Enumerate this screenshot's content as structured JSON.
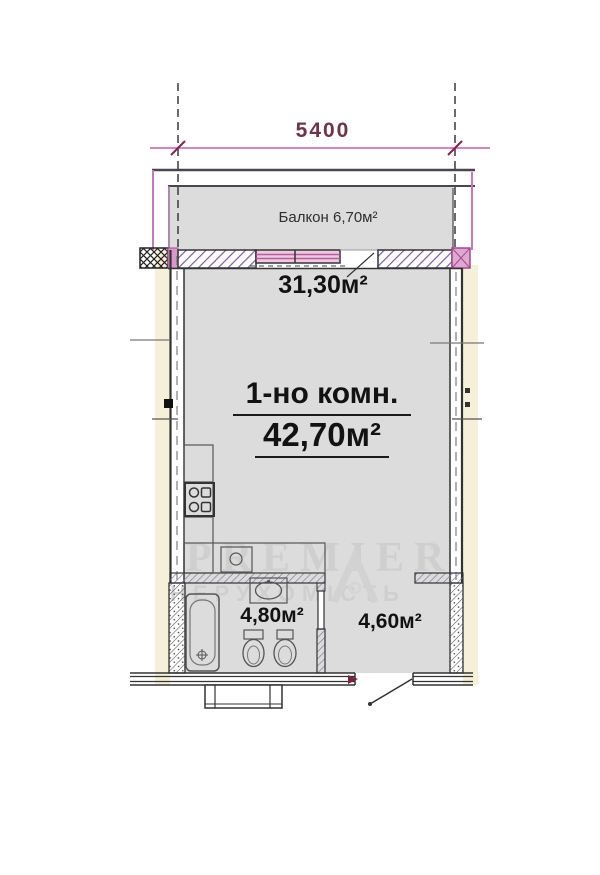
{
  "document_title": "Однокомнатная квартира — план",
  "dimension": {
    "width_label": "5400"
  },
  "balcony": {
    "label": "Балкон 6,70м²"
  },
  "room": {
    "area_label": "31,30м²",
    "type_label": "1-но комн.",
    "total_area_label": "42,70м²"
  },
  "bathroom": {
    "area_label": "4,80м²"
  },
  "hallway": {
    "area_label": "4,60м²"
  },
  "watermark": {
    "brand": "PREMIER",
    "registered": "®",
    "subtitle": "НЕРУХОМІСТЬ"
  },
  "fixtures": [
    "window-icon",
    "balcony-door-opening",
    "bathtub-icon",
    "washbasin-icon",
    "toilet-icon",
    "bidet-icon",
    "stove-icon",
    "kitchen-sink-icon",
    "entrance-door-icon"
  ],
  "colors": {
    "room_fill": "#dcdcdc",
    "outer_strip": "#f6efd9",
    "wall_line": "#333333",
    "wall_hatch_purple": "#7d5c9e",
    "dimension_line": "#c060a8",
    "dimension_text": "#6e3448",
    "window_fill": "#f0c8e0",
    "watermark_gray": "#cdcdcd"
  }
}
